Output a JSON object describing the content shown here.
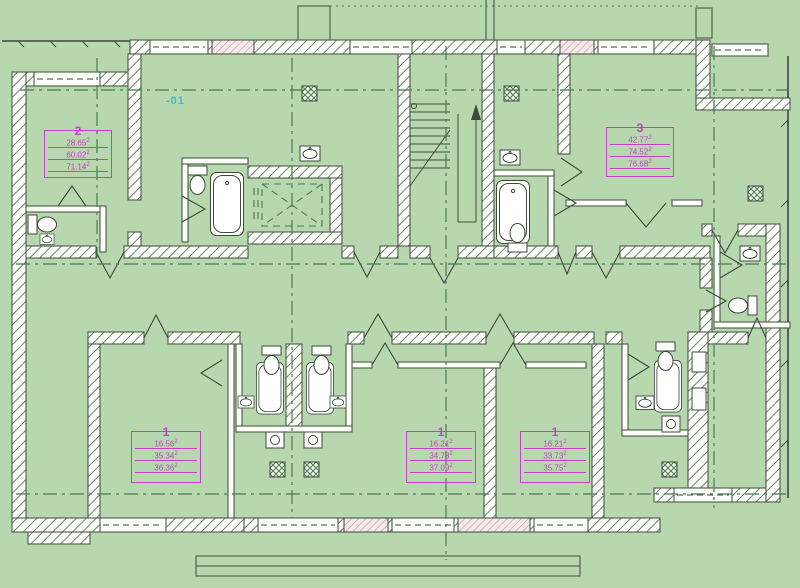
{
  "plan": {
    "floor_label": "-01",
    "colors": {
      "bg": "#b7d8af",
      "wall_line": "#3c4a3a",
      "hatch_line": "#5f6b5a",
      "window_pink": "#c493a3",
      "centerline": "#4a7a50",
      "magenta": "#c73ec7",
      "cyan": "#46b6c9"
    },
    "apartments": [
      {
        "number": "2",
        "areas": [
          {
            "v": "28.65",
            "u": "2"
          },
          {
            "v": "60.02",
            "u": "2"
          },
          {
            "v": "71.14",
            "u": "2"
          }
        ]
      },
      {
        "number": "3",
        "areas": [
          {
            "v": "42.77",
            "u": "2"
          },
          {
            "v": "74.52",
            "u": "2"
          },
          {
            "v": "76.68",
            "u": "2"
          }
        ]
      },
      {
        "number": "1",
        "areas": [
          {
            "v": "16.56",
            "u": "2"
          },
          {
            "v": "35.34",
            "u": "2"
          },
          {
            "v": "36.36",
            "u": "2"
          }
        ]
      },
      {
        "number": "1",
        "areas": [
          {
            "v": "16.21",
            "u": "2"
          },
          {
            "v": "34.78",
            "u": "2"
          },
          {
            "v": "37.09",
            "u": "2"
          }
        ]
      },
      {
        "number": "1",
        "areas": [
          {
            "v": "16.21",
            "u": "2"
          },
          {
            "v": "33.73",
            "u": "2"
          },
          {
            "v": "35.75",
            "u": "2"
          }
        ]
      }
    ]
  }
}
